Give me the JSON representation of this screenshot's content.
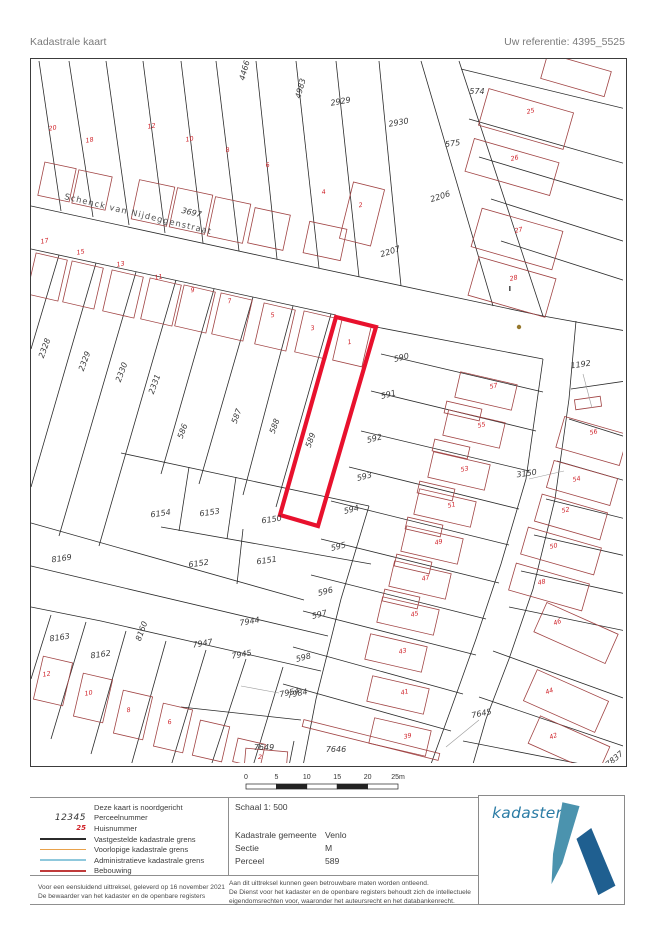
{
  "header": {
    "title": "Kadastrale kaart",
    "reference": "Uw referentie: 4395_5525"
  },
  "map": {
    "street_name": "Schenck van Nijdeggenstraat",
    "highlighted_parcel": "589",
    "colors": {
      "boundary": "#2b2b2b",
      "building": "#a04343",
      "highlight": "#e8112d",
      "parcel_text": "#3a3a3a",
      "house_text": "#cf2128",
      "street_text": "#4f4f4f",
      "leader": "#9b9b9b",
      "dot": "#96782d"
    },
    "parcel_labels": [
      {
        "t": "4466",
        "x": 216,
        "y": 12,
        "r": -75
      },
      {
        "t": "4983",
        "x": 272,
        "y": 30,
        "r": -75
      },
      {
        "t": "2929",
        "x": 310,
        "y": 45,
        "r": -10
      },
      {
        "t": "2930",
        "x": 368,
        "y": 66,
        "r": -10
      },
      {
        "t": "574",
        "x": 446,
        "y": 35,
        "r": 0
      },
      {
        "t": "575",
        "x": 422,
        "y": 87,
        "r": -8
      },
      {
        "t": "2206",
        "x": 410,
        "y": 140,
        "r": -18
      },
      {
        "t": "2207",
        "x": 360,
        "y": 195,
        "r": -18
      },
      {
        "t": "3697",
        "x": 160,
        "y": 156,
        "r": 13
      },
      {
        "t": "2328",
        "x": 16,
        "y": 290,
        "r": -70
      },
      {
        "t": "2329",
        "x": 56,
        "y": 303,
        "r": -70
      },
      {
        "t": "2330",
        "x": 93,
        "y": 314,
        "r": -70
      },
      {
        "t": "2331",
        "x": 126,
        "y": 326,
        "r": -70
      },
      {
        "t": "586",
        "x": 154,
        "y": 373,
        "r": -70
      },
      {
        "t": "587",
        "x": 208,
        "y": 358,
        "r": -70
      },
      {
        "t": "588",
        "x": 246,
        "y": 368,
        "r": -70
      },
      {
        "t": "589",
        "x": 282,
        "y": 382,
        "r": -70
      },
      {
        "t": "590",
        "x": 371,
        "y": 301,
        "r": -14
      },
      {
        "t": "591",
        "x": 358,
        "y": 338,
        "r": -14
      },
      {
        "t": "592",
        "x": 344,
        "y": 382,
        "r": -14
      },
      {
        "t": "593",
        "x": 334,
        "y": 420,
        "r": -14
      },
      {
        "t": "594",
        "x": 321,
        "y": 453,
        "r": -14
      },
      {
        "t": "595",
        "x": 308,
        "y": 490,
        "r": -14
      },
      {
        "t": "596",
        "x": 295,
        "y": 535,
        "r": -14
      },
      {
        "t": "597",
        "x": 289,
        "y": 558,
        "r": -14
      },
      {
        "t": "598",
        "x": 273,
        "y": 601,
        "r": -14
      },
      {
        "t": "1192",
        "x": 550,
        "y": 308,
        "r": -8
      },
      {
        "t": "3150",
        "x": 496,
        "y": 417,
        "r": -8
      },
      {
        "t": "6154",
        "x": 130,
        "y": 457,
        "r": -8
      },
      {
        "t": "6153",
        "x": 179,
        "y": 456,
        "r": -8
      },
      {
        "t": "6150",
        "x": 241,
        "y": 463,
        "r": -8
      },
      {
        "t": "6152",
        "x": 168,
        "y": 507,
        "r": -8
      },
      {
        "t": "6151",
        "x": 236,
        "y": 504,
        "r": -8
      },
      {
        "t": "8169",
        "x": 31,
        "y": 502,
        "r": -8
      },
      {
        "t": "8163",
        "x": 29,
        "y": 581,
        "r": -8
      },
      {
        "t": "8162",
        "x": 70,
        "y": 598,
        "r": -8
      },
      {
        "t": "8160",
        "x": 113,
        "y": 573,
        "r": -70
      },
      {
        "t": "7947",
        "x": 172,
        "y": 587,
        "r": -10
      },
      {
        "t": "7944",
        "x": 219,
        "y": 565,
        "r": -10
      },
      {
        "t": "7945",
        "x": 211,
        "y": 598,
        "r": -10
      },
      {
        "t": "7954",
        "x": 259,
        "y": 636,
        "r": -12
      },
      {
        "t": "7984",
        "x": 267,
        "y": 637,
        "r": -12
      },
      {
        "t": "7649",
        "x": 233,
        "y": 691,
        "r": 0
      },
      {
        "t": "7646",
        "x": 305,
        "y": 693,
        "r": 0
      },
      {
        "t": "7645",
        "x": 451,
        "y": 657,
        "r": -12
      },
      {
        "t": "7837",
        "x": 585,
        "y": 702,
        "r": -40
      }
    ],
    "house_numbers": [
      {
        "t": "20",
        "x": 22,
        "y": 71,
        "r": -10
      },
      {
        "t": "18",
        "x": 59,
        "y": 83,
        "r": -10
      },
      {
        "t": "12",
        "x": 121,
        "y": 69,
        "r": -10
      },
      {
        "t": "10",
        "x": 159,
        "y": 82,
        "r": -10
      },
      {
        "t": "8",
        "x": 197,
        "y": 93,
        "r": -10
      },
      {
        "t": "6",
        "x": 237,
        "y": 108,
        "r": -10
      },
      {
        "t": "4",
        "x": 293,
        "y": 135,
        "r": -10
      },
      {
        "t": "2",
        "x": 330,
        "y": 148,
        "r": -10
      },
      {
        "t": "25",
        "x": 500,
        "y": 54,
        "r": -12
      },
      {
        "t": "26",
        "x": 484,
        "y": 101,
        "r": -12
      },
      {
        "t": "27",
        "x": 488,
        "y": 173,
        "r": -12
      },
      {
        "t": "28",
        "x": 483,
        "y": 221,
        "r": -12
      },
      {
        "t": "17",
        "x": 14,
        "y": 184,
        "r": -10
      },
      {
        "t": "15",
        "x": 50,
        "y": 195,
        "r": -10
      },
      {
        "t": "13",
        "x": 90,
        "y": 207,
        "r": -10
      },
      {
        "t": "11",
        "x": 128,
        "y": 220,
        "r": -10
      },
      {
        "t": "9",
        "x": 162,
        "y": 233,
        "r": -10
      },
      {
        "t": "7",
        "x": 199,
        "y": 244,
        "r": -10
      },
      {
        "t": "5",
        "x": 242,
        "y": 258,
        "r": -10
      },
      {
        "t": "3",
        "x": 282,
        "y": 271,
        "r": -10
      },
      {
        "t": "1",
        "x": 319,
        "y": 285,
        "r": -10
      },
      {
        "t": "57",
        "x": 463,
        "y": 329,
        "r": -12
      },
      {
        "t": "55",
        "x": 451,
        "y": 368,
        "r": -12
      },
      {
        "t": "53",
        "x": 434,
        "y": 412,
        "r": -12
      },
      {
        "t": "51",
        "x": 421,
        "y": 448,
        "r": -12
      },
      {
        "t": "49",
        "x": 408,
        "y": 485,
        "r": -12
      },
      {
        "t": "47",
        "x": 395,
        "y": 521,
        "r": -12
      },
      {
        "t": "45",
        "x": 384,
        "y": 557,
        "r": -12
      },
      {
        "t": "43",
        "x": 372,
        "y": 594,
        "r": -12
      },
      {
        "t": "41",
        "x": 374,
        "y": 635,
        "r": -12
      },
      {
        "t": "39",
        "x": 377,
        "y": 679,
        "r": -12
      },
      {
        "t": "56",
        "x": 563,
        "y": 375,
        "r": -12
      },
      {
        "t": "54",
        "x": 546,
        "y": 422,
        "r": -12
      },
      {
        "t": "52",
        "x": 535,
        "y": 453,
        "r": -12
      },
      {
        "t": "50",
        "x": 523,
        "y": 489,
        "r": -12
      },
      {
        "t": "48",
        "x": 511,
        "y": 525,
        "r": -12
      },
      {
        "t": "46",
        "x": 527,
        "y": 565,
        "r": -20
      },
      {
        "t": "44",
        "x": 519,
        "y": 634,
        "r": -20
      },
      {
        "t": "42",
        "x": 523,
        "y": 679,
        "r": -20
      },
      {
        "t": "12",
        "x": 16,
        "y": 617,
        "r": -10
      },
      {
        "t": "10",
        "x": 58,
        "y": 636,
        "r": -10
      },
      {
        "t": "8",
        "x": 98,
        "y": 653,
        "r": -10
      },
      {
        "t": "6",
        "x": 139,
        "y": 665,
        "r": -10
      },
      {
        "t": "2",
        "x": 229,
        "y": 700,
        "r": 0
      }
    ],
    "street_label": {
      "x": 33,
      "y": 140,
      "r": 13.5
    },
    "boundaries": [
      "0,147 240,199 512,257",
      "0,190 305,256",
      "345,268 512,300",
      "512,257 595,272",
      "390,2 462,247",
      "428,2 512,257",
      "8,2 30,152",
      "38,2 62,158",
      "75,2 98,166",
      "112,2 134,174",
      "150,2 172,184",
      "185,2 208,192",
      "225,2 246,200",
      "265,2 288,209",
      "305,2 328,218",
      "348,2 370,227",
      "430,10 595,50",
      "438,60 595,105",
      "448,98 595,142",
      "460,140 595,183",
      "470,182 595,222",
      "512,300 495,420 470,505 445,580 420,650 400,705",
      "545,262 538,340 524,440 502,530 478,600 455,660 442,705",
      "540,330 595,322",
      "538,360 595,378",
      "526,402 595,422",
      "515,440 595,460",
      "503,476 595,497",
      "490,512 595,535",
      "478,548 595,572",
      "462,592 595,640",
      "448,638 595,688",
      "432,682 560,707",
      "28,196 0,290",
      "65,204 0,428",
      "105,213 28,477",
      "145,221 68,487",
      "183,230 130,415",
      "222,238 168,425",
      "262,247 212,436",
      "300,255 245,448",
      "90,394 338,447",
      "158,408 148,472",
      "205,418 196,480",
      "130,468 340,505",
      "212,470 206,525",
      "0,464 273,541",
      "338,447 310,540 285,640 272,707",
      "0,507 55,520 297,577",
      "0,548 70,562 290,612",
      "20,556 0,620",
      "55,563 20,680",
      "95,572 60,695",
      "135,582 100,707",
      "175,591 140,707",
      "215,600 180,707",
      "252,608 222,707",
      "350,295 512,333",
      "340,332 505,372",
      "330,372 498,412",
      "318,408 488,450",
      "300,442 478,486",
      "290,480 468,524",
      "280,516 455,560",
      "272,552 445,596",
      "262,588 432,635",
      "252,625 420,672",
      "150,648 270,661",
      "263,682 258,707"
    ],
    "buildings": [
      {
        "x": 26,
        "y": 123,
        "w": 32,
        "h": 34,
        "r": 12
      },
      {
        "x": 61,
        "y": 131,
        "w": 34,
        "h": 34,
        "r": 12
      },
      {
        "x": 122,
        "y": 144,
        "w": 36,
        "h": 40,
        "r": 12
      },
      {
        "x": 160,
        "y": 152,
        "w": 36,
        "h": 40,
        "r": 12
      },
      {
        "x": 198,
        "y": 161,
        "w": 36,
        "h": 40,
        "r": 12
      },
      {
        "x": 238,
        "y": 170,
        "w": 36,
        "h": 36,
        "r": 12
      },
      {
        "x": 294,
        "y": 182,
        "w": 38,
        "h": 32,
        "r": 12
      },
      {
        "x": 331,
        "y": 155,
        "w": 32,
        "h": 58,
        "r": 14
      },
      {
        "x": 495,
        "y": 60,
        "w": 88,
        "h": 38,
        "r": 16
      },
      {
        "x": 481,
        "y": 108,
        "w": 88,
        "h": 34,
        "r": 16
      },
      {
        "x": 486,
        "y": 180,
        "w": 84,
        "h": 40,
        "r": 16
      },
      {
        "x": 481,
        "y": 228,
        "w": 80,
        "h": 40,
        "r": 16
      },
      {
        "x": 545,
        "y": 16,
        "w": 66,
        "h": 26,
        "r": 16
      },
      {
        "x": 16,
        "y": 218,
        "w": 32,
        "h": 42,
        "r": 13
      },
      {
        "x": 52,
        "y": 226,
        "w": 32,
        "h": 42,
        "r": 13
      },
      {
        "x": 92,
        "y": 235,
        "w": 32,
        "h": 42,
        "r": 13
      },
      {
        "x": 130,
        "y": 243,
        "w": 32,
        "h": 42,
        "r": 13
      },
      {
        "x": 164,
        "y": 250,
        "w": 32,
        "h": 42,
        "r": 13
      },
      {
        "x": 201,
        "y": 258,
        "w": 32,
        "h": 42,
        "r": 13
      },
      {
        "x": 244,
        "y": 268,
        "w": 32,
        "h": 42,
        "r": 13
      },
      {
        "x": 284,
        "y": 276,
        "w": 32,
        "h": 42,
        "r": 13
      },
      {
        "x": 321,
        "y": 284,
        "w": 30,
        "h": 42,
        "r": 13
      },
      {
        "x": 455,
        "y": 332,
        "w": 58,
        "h": 26,
        "r": 13
      },
      {
        "x": 443,
        "y": 370,
        "w": 58,
        "h": 26,
        "r": 13
      },
      {
        "x": 428,
        "y": 412,
        "w": 58,
        "h": 26,
        "r": 13
      },
      {
        "x": 414,
        "y": 449,
        "w": 58,
        "h": 26,
        "r": 13
      },
      {
        "x": 401,
        "y": 486,
        "w": 58,
        "h": 26,
        "r": 13
      },
      {
        "x": 389,
        "y": 521,
        "w": 58,
        "h": 26,
        "r": 13
      },
      {
        "x": 377,
        "y": 557,
        "w": 58,
        "h": 26,
        "r": 13
      },
      {
        "x": 365,
        "y": 594,
        "w": 58,
        "h": 26,
        "r": 13
      },
      {
        "x": 367,
        "y": 636,
        "w": 58,
        "h": 26,
        "r": 13
      },
      {
        "x": 369,
        "y": 678,
        "w": 58,
        "h": 26,
        "r": 13
      },
      {
        "x": 432,
        "y": 352,
        "w": 36,
        "h": 12,
        "r": 13
      },
      {
        "x": 420,
        "y": 390,
        "w": 36,
        "h": 12,
        "r": 13
      },
      {
        "x": 405,
        "y": 432,
        "w": 36,
        "h": 12,
        "r": 13
      },
      {
        "x": 393,
        "y": 468,
        "w": 36,
        "h": 12,
        "r": 13
      },
      {
        "x": 382,
        "y": 505,
        "w": 36,
        "h": 12,
        "r": 13
      },
      {
        "x": 370,
        "y": 540,
        "w": 36,
        "h": 12,
        "r": 13
      },
      {
        "x": 561,
        "y": 382,
        "w": 66,
        "h": 32,
        "r": 16
      },
      {
        "x": 551,
        "y": 424,
        "w": 66,
        "h": 28,
        "r": 16
      },
      {
        "x": 540,
        "y": 458,
        "w": 68,
        "h": 28,
        "r": 16
      },
      {
        "x": 530,
        "y": 492,
        "w": 76,
        "h": 28,
        "r": 16
      },
      {
        "x": 518,
        "y": 528,
        "w": 76,
        "h": 28,
        "r": 16
      },
      {
        "x": 545,
        "y": 574,
        "w": 78,
        "h": 32,
        "r": 24
      },
      {
        "x": 535,
        "y": 642,
        "w": 78,
        "h": 34,
        "r": 24
      },
      {
        "x": 538,
        "y": 686,
        "w": 76,
        "h": 30,
        "r": 24
      },
      {
        "x": 557,
        "y": 344,
        "w": 26,
        "h": 10,
        "r": -8
      },
      {
        "x": 22,
        "y": 622,
        "w": 30,
        "h": 44,
        "r": 13
      },
      {
        "x": 62,
        "y": 639,
        "w": 30,
        "h": 44,
        "r": 13
      },
      {
        "x": 102,
        "y": 656,
        "w": 30,
        "h": 44,
        "r": 13
      },
      {
        "x": 142,
        "y": 669,
        "w": 30,
        "h": 44,
        "r": 13
      },
      {
        "x": 180,
        "y": 682,
        "w": 30,
        "h": 36,
        "r": 13
      },
      {
        "x": 218,
        "y": 694,
        "w": 28,
        "h": 24,
        "r": 13
      },
      {
        "x": 235,
        "y": 700,
        "w": 42,
        "h": 18,
        "r": 5
      },
      {
        "x": 340,
        "y": 681,
        "w": 140,
        "h": 7,
        "r": 14
      }
    ],
    "highlight_polygon": "305,258 345,268 287,467 249,456",
    "leaders": [
      {
        "x1": 552,
        "y1": 315,
        "x2": 561,
        "y2": 349
      },
      {
        "x1": 498,
        "y1": 420,
        "x2": 533,
        "y2": 412
      },
      {
        "x1": 448,
        "y1": 661,
        "x2": 415,
        "y2": 688
      },
      {
        "x1": 210,
        "y1": 627,
        "x2": 248,
        "y2": 634
      }
    ],
    "dot": {
      "x": 488,
      "y": 268
    },
    "symbol": {
      "x": 478,
      "y": 227
    }
  },
  "scalebar": {
    "ticks": [
      "0",
      "5",
      "10",
      "15",
      "20",
      "25m"
    ]
  },
  "legend": {
    "items": [
      {
        "label": "Deze kaart is noordgericht",
        "swatch": "none",
        "color": ""
      },
      {
        "label": "Perceelnummer",
        "swatch": "perceel",
        "color": "#333333",
        "sample": "12345"
      },
      {
        "label": "Huisnummer",
        "swatch": "huis",
        "color": "#cf2128",
        "sample": "25"
      },
      {
        "label": "Vastgestelde kadastrale grens",
        "swatch": "line",
        "color": "#2b2b2b"
      },
      {
        "label": "Voorlopige kadastrale grens",
        "swatch": "line",
        "color": "#e9a24b"
      },
      {
        "label": "Administratieve kadastrale grens",
        "swatch": "line",
        "color": "#8fc8dc"
      },
      {
        "label": "Bebouwing",
        "swatch": "line",
        "color": "#c03b3b"
      }
    ]
  },
  "info": {
    "schaal": "Schaal 1: 500",
    "rows": [
      {
        "k": "Kadastrale gemeente",
        "v": "Venlo"
      },
      {
        "k": "Sectie",
        "v": "M"
      },
      {
        "k": "Perceel",
        "v": "589"
      }
    ]
  },
  "logo": {
    "text": "kadaster"
  },
  "footer": {
    "left": [
      "Voor een eensluidend uittreksel, geleverd op 16 november 2021",
      "De bewaarder van het kadaster en de openbare registers"
    ],
    "right": [
      "Aan dit uittreksel kunnen geen betrouwbare maten worden ontleend.",
      "De Dienst voor het kadaster en de openbare registers behoudt zich de intellectuele",
      "eigendomsrechten voor, waaronder het auteursrecht en het databankenrecht."
    ]
  }
}
